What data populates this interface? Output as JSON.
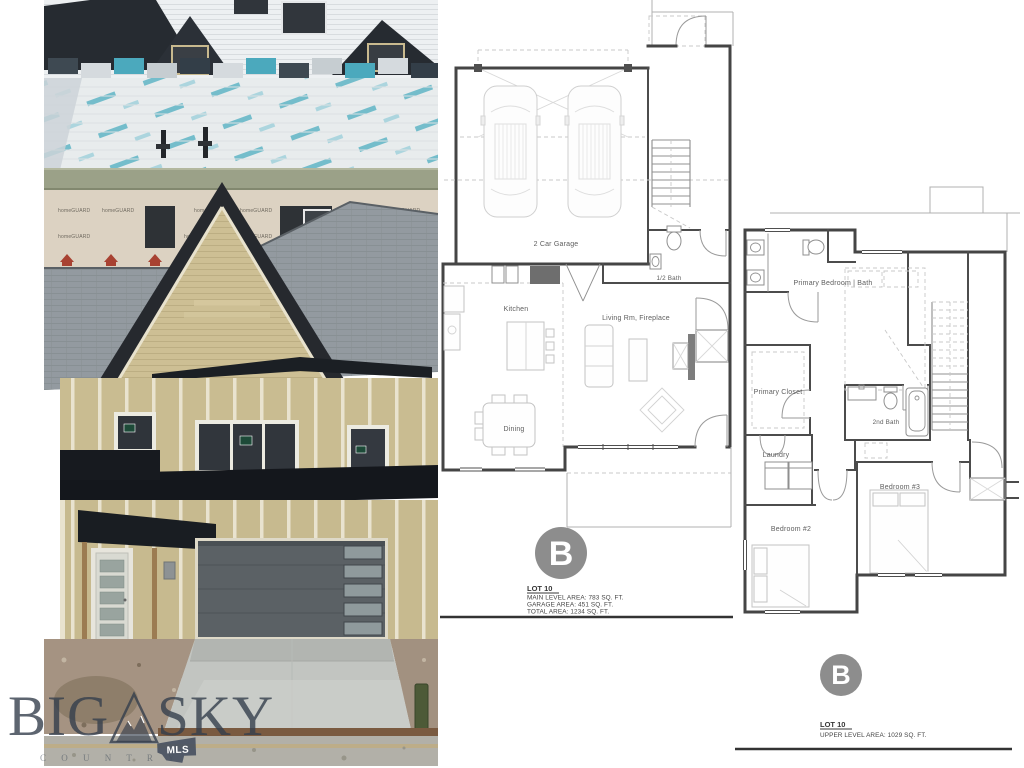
{
  "watermark": {
    "word1": "BIG",
    "word2": "SKY",
    "subtext": "C O U N T R Y",
    "mls": "MLS"
  },
  "photo": {
    "wrap_brand": "homeGUARD"
  },
  "main_plan": {
    "badge": "B",
    "lot": "LOT 10",
    "rooms": {
      "garage": "2 Car Garage",
      "half_bath": "1/2 Bath",
      "kitchen": "Kitchen",
      "living": "Living Rm, Fireplace",
      "dining": "Dining"
    },
    "areas": {
      "line1": "MAIN LEVEL AREA: 783 SQ. FT.",
      "line2": "GARAGE AREA: 451 SQ. FT.",
      "line3": "TOTAL AREA: 1234 SQ. FT."
    }
  },
  "upper_plan": {
    "badge": "B",
    "lot": "LOT 10",
    "rooms": {
      "primary": "Primary Bedroom | Bath",
      "primary_closet": "Primary Closet",
      "second_bath": "2nd Bath",
      "laundry": "Laundry",
      "bedroom2": "Bedroom #2",
      "bedroom3": "Bedroom #3"
    },
    "areas": {
      "line1": "UPPER LEVEL AREA: 1029 SQ. FT."
    }
  },
  "colors": {
    "badge": "#8d8d8d",
    "wall": "#474747",
    "teal": "#57b3c4",
    "siding": "#cabd92",
    "watermark": "#36404f"
  }
}
